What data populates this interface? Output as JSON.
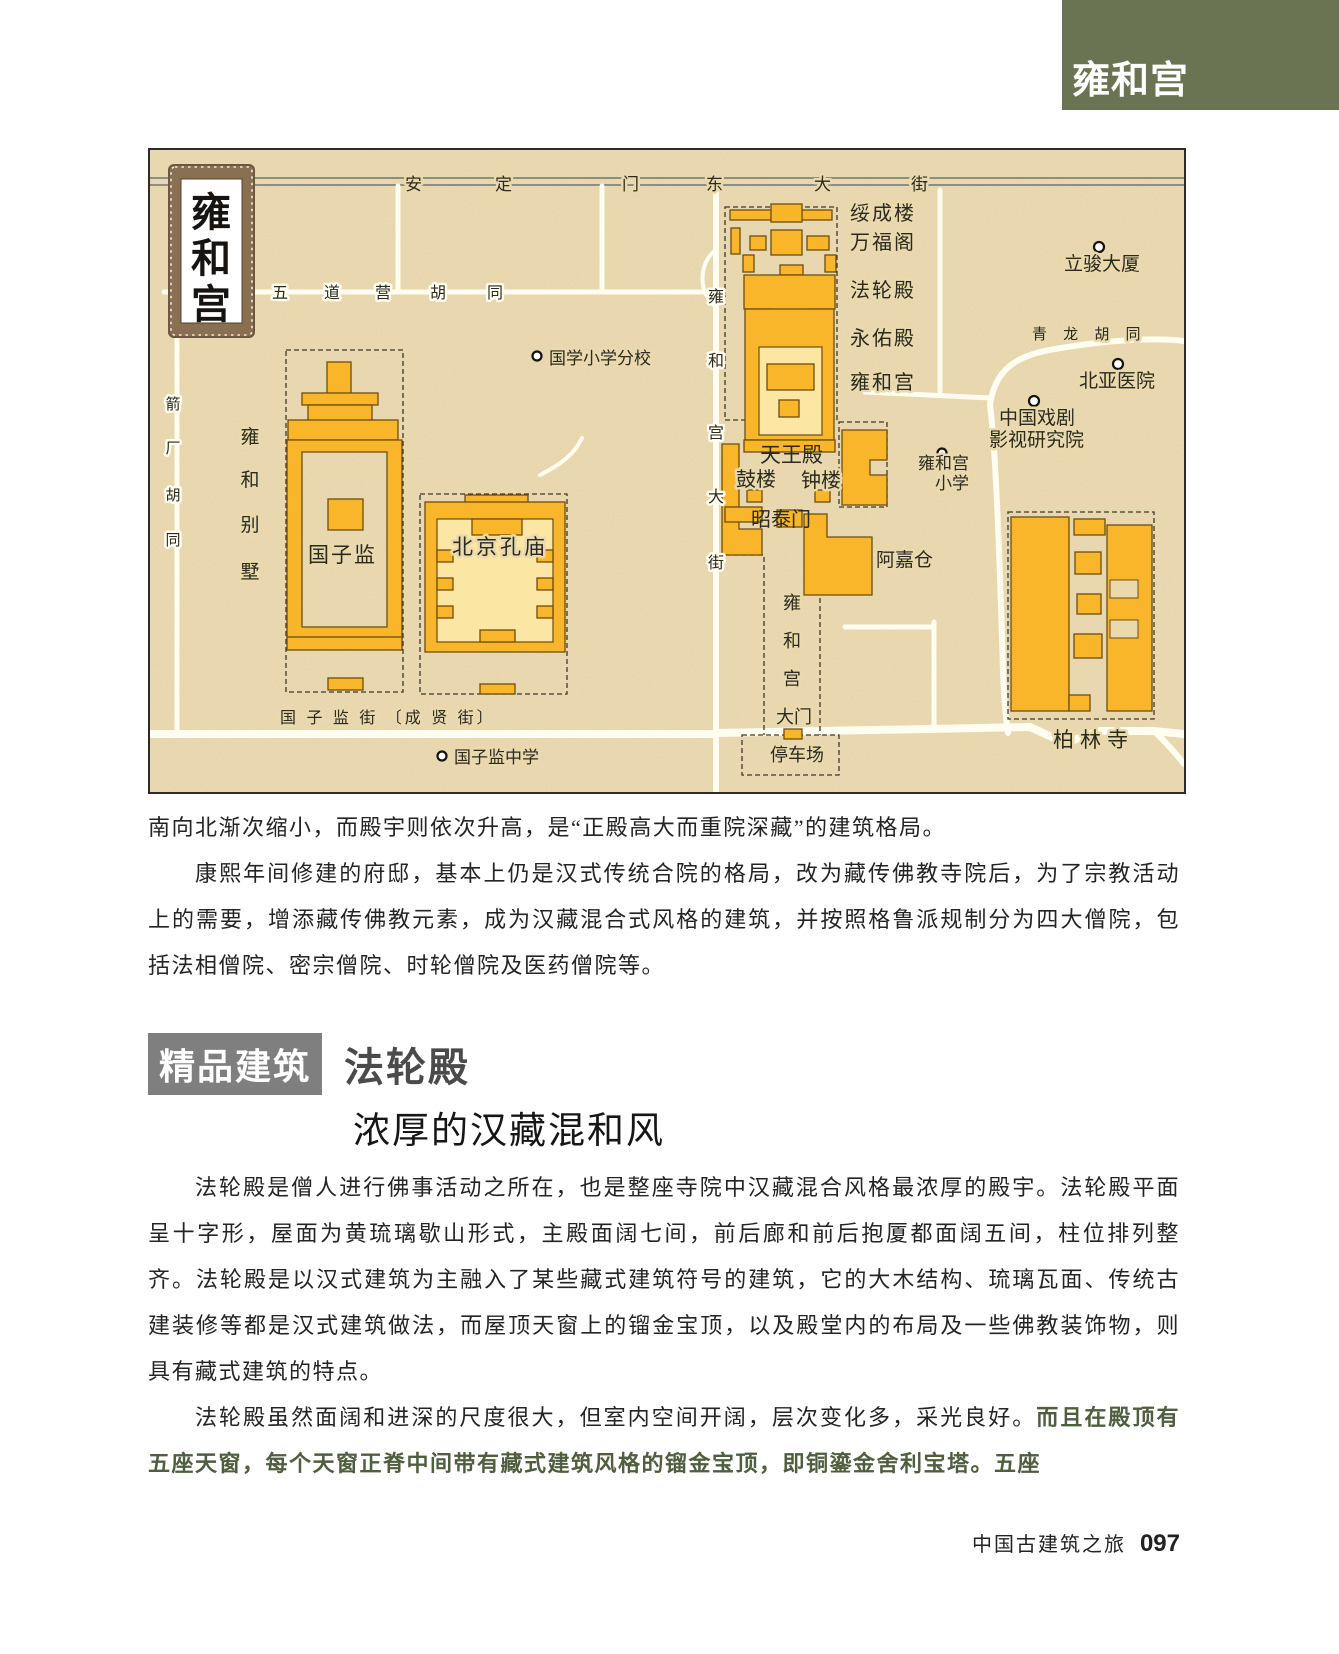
{
  "header": {
    "tab": "雍和宫"
  },
  "colors": {
    "accent_green": "#6b7452",
    "building_orange": "#f9b62a",
    "courtyard_light": "#fbe6a3",
    "map_paper": "#ebd9ae",
    "section_tag_gray": "#7f7f7f",
    "highlight_green": "#4f5e3e"
  },
  "map": {
    "stamp": [
      "雍",
      "和",
      "宫"
    ],
    "andingmen": [
      "安",
      "定",
      "门",
      "东",
      "大",
      "街"
    ],
    "wudaoying": [
      "五",
      "道",
      "营",
      "胡",
      "同"
    ],
    "ygdj": [
      "雍",
      "和",
      "宫",
      "大",
      "街"
    ],
    "jianchang": [
      "箭",
      "厂",
      "胡",
      "同"
    ],
    "villa": [
      "雍",
      "和",
      "别",
      "墅"
    ],
    "gzj_street": "国 子 监 街 〔成 贤 街〕",
    "qinglong": "青 龙 胡 同",
    "halls": [
      "绥成楼",
      "万福阁",
      "法轮殿",
      "永佑殿",
      "雍和宫"
    ],
    "tianwang": "天王殿",
    "gulou": "鼓楼",
    "zhonglou": "钟楼",
    "zhaotai": "昭泰门",
    "guozijian": "国子监",
    "kongmiao": "北京孔庙",
    "ajiacang": "阿嘉仓",
    "bailinsi": "柏林寺",
    "parking": "停车场",
    "gate": [
      "雍",
      "和",
      "宫"
    ],
    "gate_door": "大门",
    "poi_guoxue": "国学小学分校",
    "poi_gzj_school": "国子监中学",
    "poi_lijun": "立骏大厦",
    "poi_beiya": "北亚医院",
    "poi_drama1": "中国戏剧",
    "poi_drama2": "影视研究院",
    "poi_yhg1": "雍和宫",
    "poi_yhg2": "小学"
  },
  "body": {
    "para1": "南向北渐次缩小，而殿宇则依次升高，是“正殿高大而重院深藏”的建筑格局。",
    "para2": "康熙年间修建的府邸，基本上仍是汉式传统合院的格局，改为藏传佛教寺院后，为了宗教活动上的需要，增添藏传佛教元素，成为汉藏混合式风格的建筑，并按照格鲁派规制分为四大僧院，包括法相僧院、密宗僧院、时轮僧院及医药僧院等。"
  },
  "section": {
    "tag": "精品建筑",
    "title": "法轮殿",
    "subtitle": "浓厚的汉藏混和风"
  },
  "body2": {
    "para1": "法轮殿是僧人进行佛事活动之所在，也是整座寺院中汉藏混合风格最浓厚的殿宇。法轮殿平面呈十字形，屋面为黄琉璃歇山形式，主殿面阔七间，前后廊和前后抱厦都面阔五间，柱位排列整齐。法轮殿是以汉式建筑为主融入了某些藏式建筑符号的建筑，它的大木结构、琉璃瓦面、传统古建装修等都是汉式建筑做法，而屋顶天窗上的镏金宝顶，以及殿堂内的布局及一些佛教装饰物，则具有藏式建筑的特点。",
    "para2_normal": "法轮殿虽然面阔和进深的尺度很大，但室内空间开阔，层次变化多，采光良好。",
    "para2_bold": "而且在殿顶有五座天窗，每个天窗正脊中间带有藏式建筑风格的镏金宝顶，即铜鎏金舍利宝塔。五座"
  },
  "footer": {
    "book": "中国古建筑之旅",
    "page": "097"
  }
}
